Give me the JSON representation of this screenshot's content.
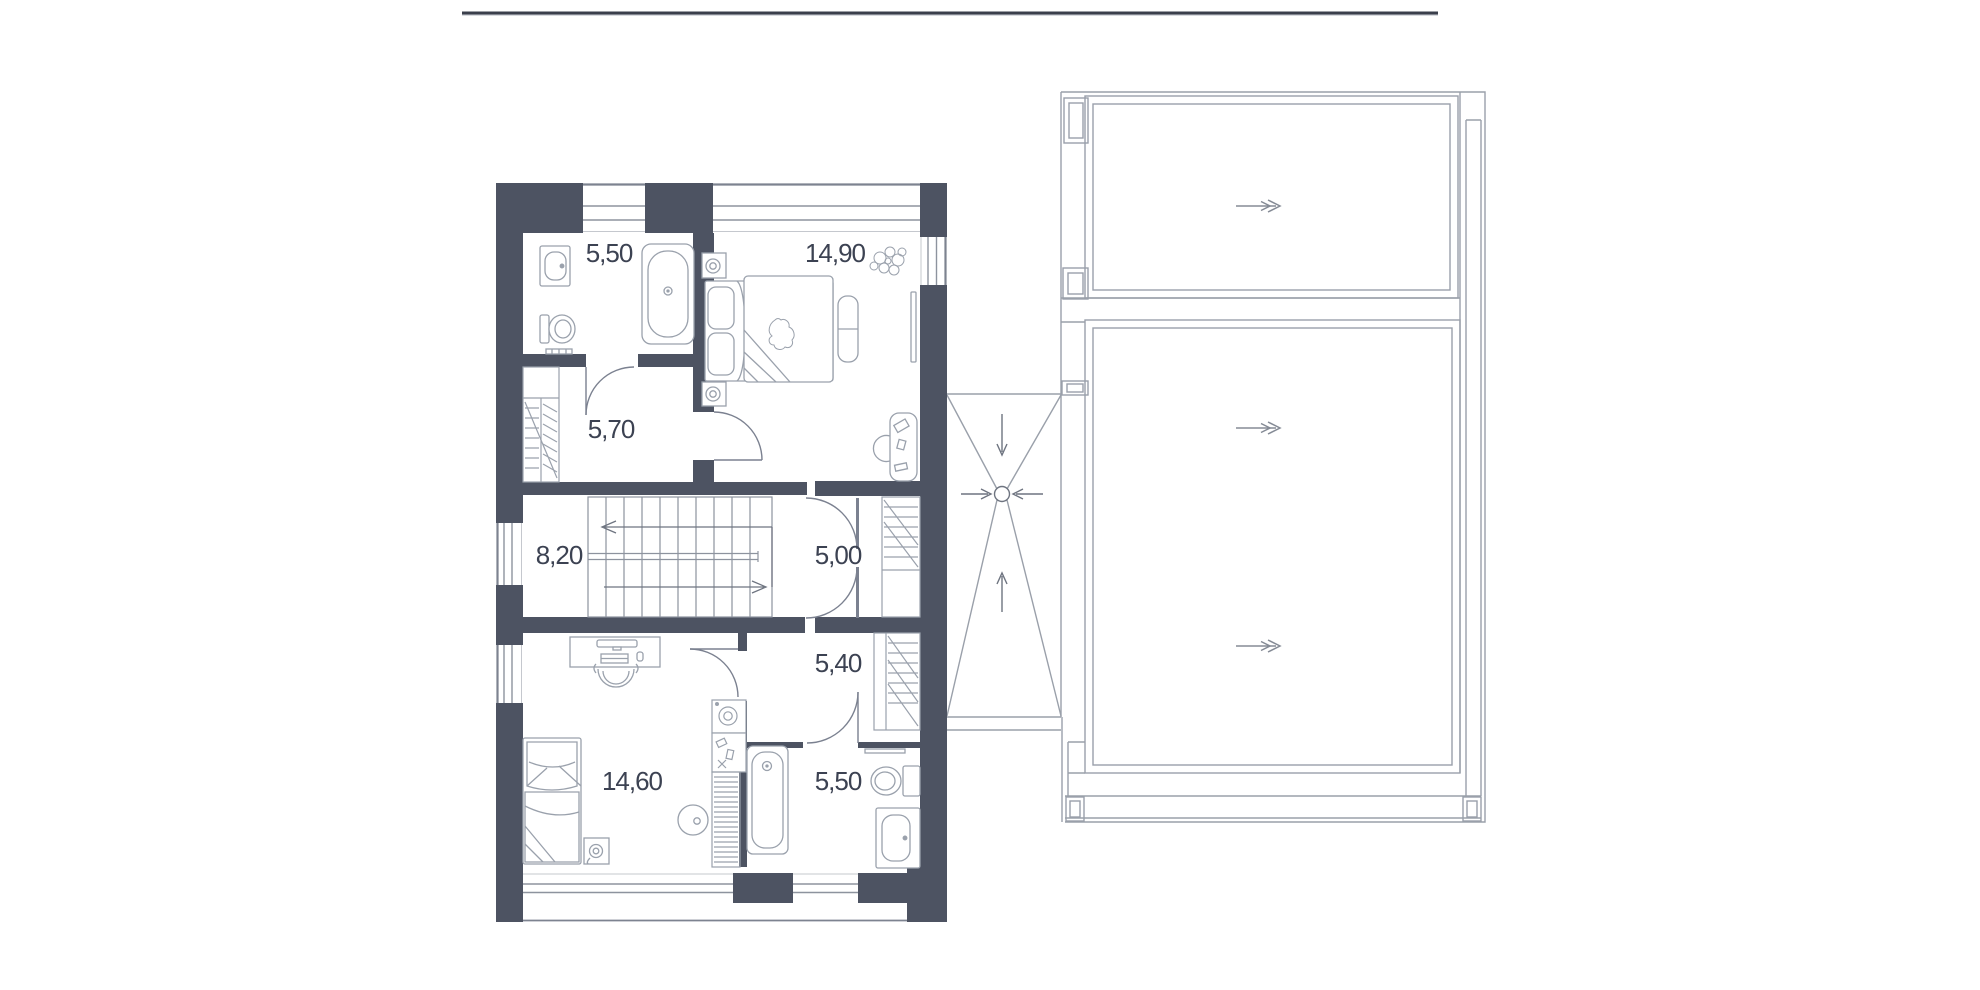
{
  "drawing": {
    "type": "floor-plan-with-roof-plan",
    "floor_plan": {
      "rooms": [
        {
          "name": "bathroom-upper",
          "area_label": "5,50"
        },
        {
          "name": "bedroom-upper",
          "area_label": "14,90"
        },
        {
          "name": "corridor",
          "area_label": "5,70"
        },
        {
          "name": "stair-hall",
          "area_label": "8,20"
        },
        {
          "name": "hallway",
          "area_label": "5,00"
        },
        {
          "name": "utility-room",
          "area_label": "5,40"
        },
        {
          "name": "bedroom-lower",
          "area_label": "14,60"
        },
        {
          "name": "bathroom-lower",
          "area_label": "5,50"
        }
      ],
      "fixtures": [
        "sink",
        "toilet",
        "bathtub",
        "bed",
        "nightstand-lamp",
        "bench",
        "tv-panel",
        "plant",
        "desk",
        "chair",
        "wardrobe",
        "stairs",
        "washing-machine",
        "rug",
        "towel-radiator"
      ],
      "stairs": {
        "direction_arrows": [
          "left",
          "right"
        ]
      }
    },
    "roof_plan": {
      "slope_arrows": [
        "right",
        "right",
        "right"
      ],
      "drain": {
        "arrows_to_center": [
          "down",
          "right",
          "left",
          "up"
        ]
      }
    },
    "colors": {
      "wall": "#4d5362",
      "furniture_line": "#9aa1ac",
      "roof_line": "#9aa0aa",
      "arrow": "#7a8190",
      "text": "#3c4252",
      "top_rule": "#3a3f4b"
    }
  }
}
